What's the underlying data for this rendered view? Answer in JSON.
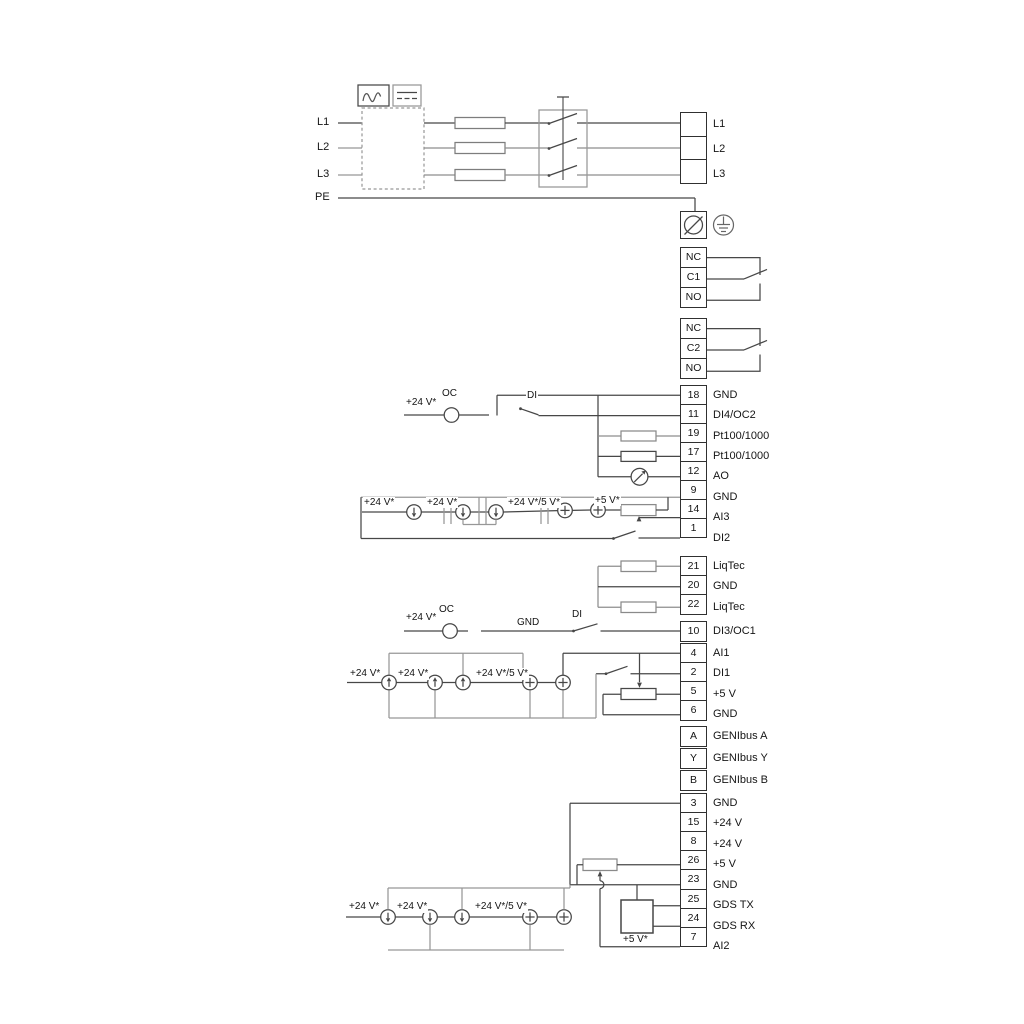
{
  "diagram_title": "Pump wiring diagram",
  "power": [
    {
      "no": "",
      "label": "L1"
    },
    {
      "no": "",
      "label": "L2"
    },
    {
      "no": "",
      "label": "L3"
    }
  ],
  "power_inputs": {
    "l1": "L1",
    "l2": "L2",
    "l3": "L3",
    "pe": "PE"
  },
  "pe": [
    {
      "no": "",
      "label": ""
    }
  ],
  "relay1": [
    {
      "no": "NC",
      "label": ""
    },
    {
      "no": "C1",
      "label": ""
    },
    {
      "no": "NO",
      "label": ""
    }
  ],
  "relay2": [
    {
      "no": "NC",
      "label": ""
    },
    {
      "no": "C2",
      "label": ""
    },
    {
      "no": "NO",
      "label": ""
    }
  ],
  "io1": [
    {
      "no": "18",
      "label": "GND"
    },
    {
      "no": "11",
      "label": "DI4/OC2"
    },
    {
      "no": "19",
      "label": "Pt100/1000"
    },
    {
      "no": "17",
      "label": "Pt100/1000"
    },
    {
      "no": "12",
      "label": "AO"
    },
    {
      "no": "9",
      "label": "GND"
    },
    {
      "no": "14",
      "label": "AI3"
    },
    {
      "no": "1",
      "label": "DI2"
    }
  ],
  "liqtec": [
    {
      "no": "21",
      "label": "LiqTec"
    },
    {
      "no": "20",
      "label": "GND"
    },
    {
      "no": "22",
      "label": "LiqTec"
    }
  ],
  "di3": [
    {
      "no": "10",
      "label": "DI3/OC1"
    }
  ],
  "io2": [
    {
      "no": "4",
      "label": "AI1"
    },
    {
      "no": "2",
      "label": "DI1"
    },
    {
      "no": "5",
      "label": "+5 V"
    },
    {
      "no": "6",
      "label": "GND"
    }
  ],
  "genibus": [
    {
      "no": "A",
      "label": "GENIbus A"
    },
    {
      "no": "Y",
      "label": "GENIbus Y"
    },
    {
      "no": "B",
      "label": "GENIbus B"
    }
  ],
  "io3": [
    {
      "no": "3",
      "label": "GND"
    },
    {
      "no": "15",
      "label": "+24 V"
    },
    {
      "no": "8",
      "label": "+24 V"
    },
    {
      "no": "26",
      "label": "+5 V"
    },
    {
      "no": "23",
      "label": "GND"
    },
    {
      "no": "25",
      "label": "GDS TX"
    },
    {
      "no": "24",
      "label": "GDS RX"
    },
    {
      "no": "7",
      "label": "AI2"
    }
  ],
  "annotations": {
    "r11_supply": "+24 V*",
    "r11_oc": "OC",
    "r11_di": "DI",
    "ai3_supply_a": "+24 V*",
    "ai3_supply_b": "+24 V*",
    "ai3_supply_c": "+24 V*/5 V*",
    "ai3_supply_d": "+5 V*",
    "r10_supply": "+24 V*",
    "r10_oc": "OC",
    "r10_gnd": "GND",
    "r10_di": "DI",
    "ai1_supply_a": "+24 V*",
    "ai1_supply_b": "+24 V*",
    "ai1_supply_c": "+24 V*/5 V*",
    "ai2_supply_a": "+24 V*",
    "ai2_supply_b": "+24 V*",
    "ai2_supply_c": "+24 V*/5 V*",
    "ai2_supply_d": "+5 V*"
  },
  "colors": {
    "wire": "#474747",
    "alt_wire": "#979797",
    "text": "#151515"
  }
}
